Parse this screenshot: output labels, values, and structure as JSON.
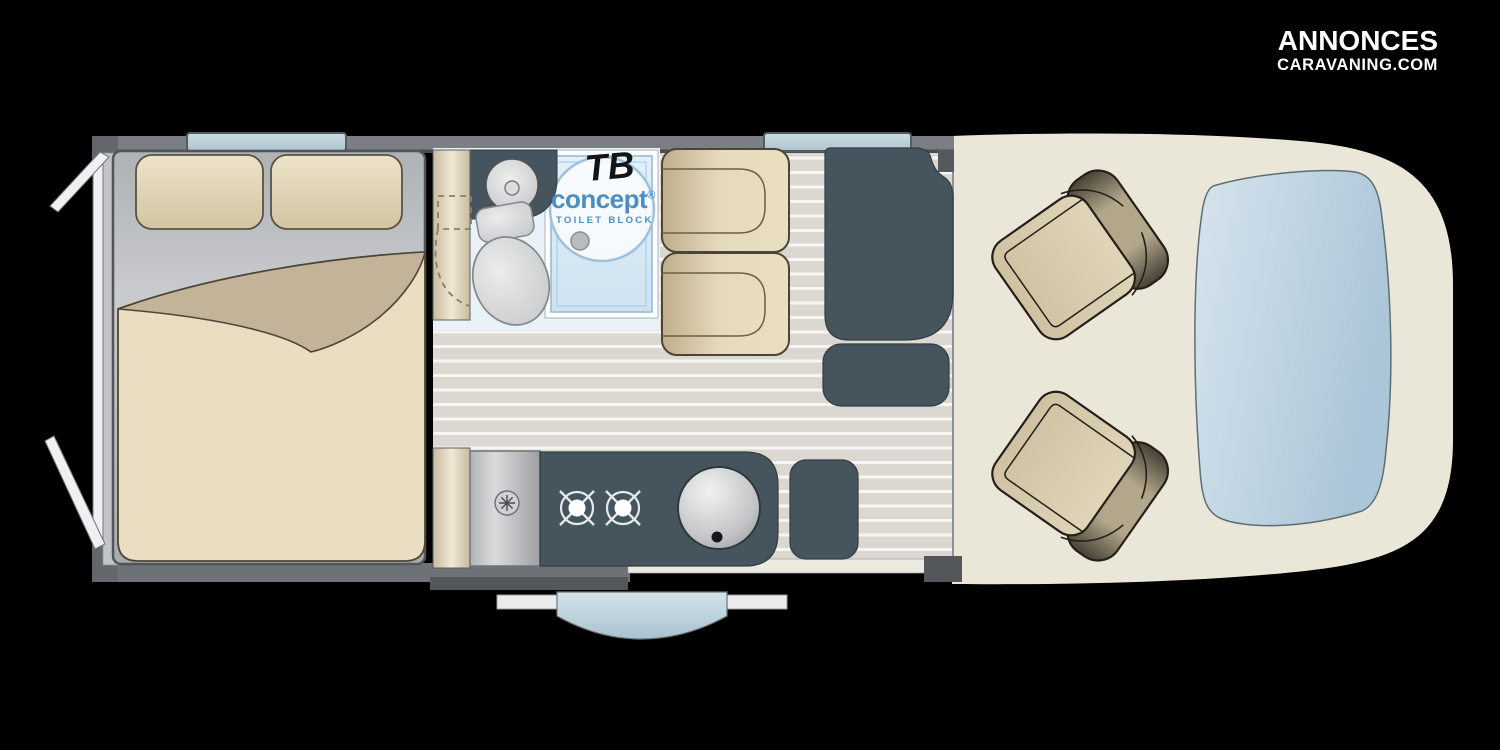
{
  "watermark": {
    "line1": "ANNONCES",
    "line2": "CARAVANING.COM",
    "color": "#ffffff"
  },
  "toilet_block_logo": {
    "abbr": "TB",
    "name": "concept",
    "registered": "®",
    "subtitle": "TOILET BLOCK",
    "text_color": "#4a8fc0",
    "abbr_color": "#141414"
  },
  "palette": {
    "background": "#000000",
    "wall_gray": "#7b7f83",
    "wall_dark": "#4a4e52",
    "floor_stripe": "#dbd8d1",
    "floor_stripe_line": "#f7f6f3",
    "upholstery_beige": "#e8ddc0",
    "duvet_fold_beige": "#c3b398",
    "furniture_teal": "#46555d",
    "bathroom_floor_blue": "#e9f2f8",
    "shower_blue": "#d9eaf5",
    "window_blue": "#c2d4dc",
    "windshield_blue": "#bfd5e3",
    "cab_floor_cream": "#eae7d9",
    "open_door_white": "#eef0f1"
  },
  "floorplan": {
    "vehicle_type": "campervan-floor-plan",
    "zones": [
      {
        "name": "rear-bedroom",
        "parts": [
          "double-bed",
          "pillow-left",
          "pillow-right",
          "duvet",
          "rear-door-left-open",
          "rear-door-right-open",
          "bedroom-window"
        ]
      },
      {
        "name": "bathroom",
        "parts": [
          "sliding-door-panel",
          "vanity-counter",
          "washbasin",
          "toilet",
          "shower-tray",
          "shower-drain",
          "toilet-block-logo",
          "door-swing-dashed"
        ]
      },
      {
        "name": "dinette",
        "parts": [
          "bench-seat-upper",
          "bench-seat-lower",
          "table-unit",
          "stool-cushion",
          "dinette-window"
        ]
      },
      {
        "name": "kitchen",
        "parts": [
          "fridge-cabinet",
          "vent-fan",
          "worktop",
          "burner-left",
          "burner-right",
          "round-sink",
          "side-cabinet"
        ]
      },
      {
        "name": "entry",
        "parts": [
          "sliding-entry-door",
          "door-rail-left",
          "door-rail-right",
          "entry-step"
        ]
      },
      {
        "name": "cab",
        "parts": [
          "driver-swivel-seat",
          "passenger-swivel-seat",
          "windshield",
          "cab-floor"
        ]
      }
    ]
  }
}
